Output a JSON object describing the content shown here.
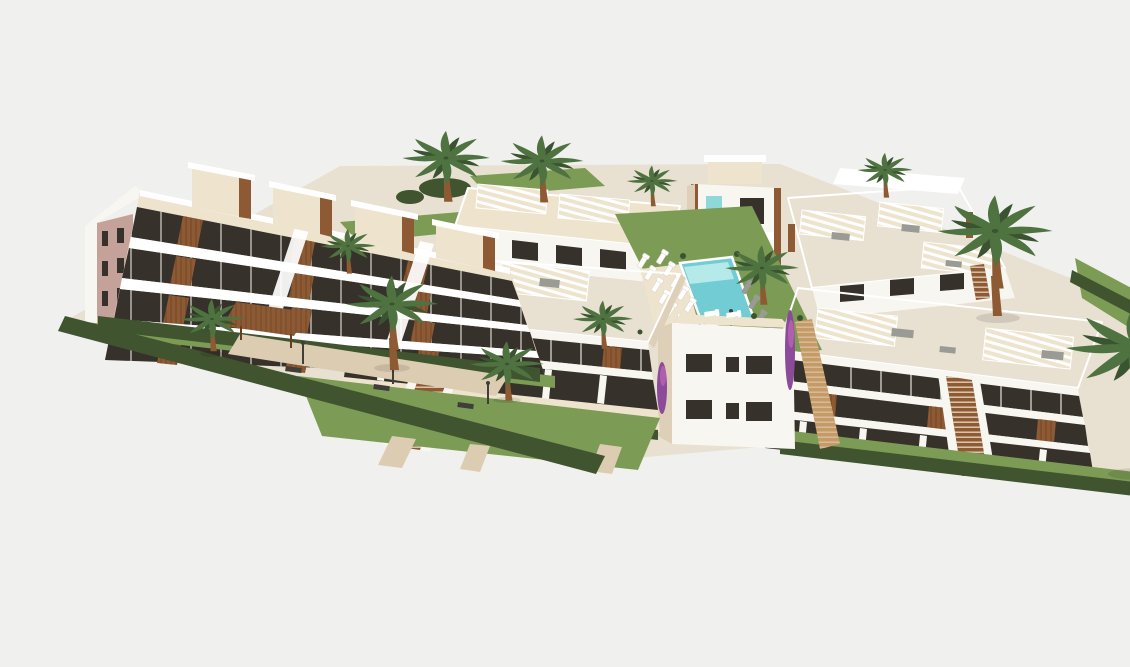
{
  "scene": {
    "type": "3d-architectural-rendering",
    "description": "Aerial 3D rendering of a modern white Mediterranean residential complex: a four-storey apartment building with stepped terraces and wooden slat panels on the left, two-storey townhouse blocks with roof terraces, striped pergolas and wooden exterior staircases in the middle and right, a communal turquoise swimming pool surrounded by lawn and sun loungers in the centre, paved walkways with benches and lamp posts, clipped hedges along the plot edges and many palm trees, all on a pale grey background.",
    "time_of_day": "day",
    "background_is_blank": true
  },
  "colors": {
    "background": "#f0f0ee",
    "ground": "#e8e0d0",
    "path": "#dccdb2",
    "path-wood": "#c49a67",
    "facade-white": "#f8f6f0",
    "facade-cream": "#eee3cc",
    "facade-tan": "#ded0b8",
    "facade-pink": "#c4a29a",
    "wood": "#8e5a33",
    "wood-dark": "#64401f",
    "glass": "#36322b",
    "glass-blue": "#8fd8da",
    "pool": "#72ccd3",
    "pool-light": "#b5e9ea",
    "lawn": "#7c9b55",
    "lawn-dark": "#63813f",
    "hedge": "#40542f",
    "palm": "#4f7340",
    "palm-dark": "#3a5330",
    "furniture-gray": "#999b94",
    "white": "#ffffff",
    "purple": "#8b4a9a",
    "magenta": "#b05fae",
    "bench": "#3f3e39"
  },
  "objects": {
    "buildings": [
      {
        "name": "left-apartment-building",
        "storeys": 4,
        "features": [
          "stepped penthouses",
          "wood slat panels",
          "pink gable end wall with six small windows",
          "balcony bands"
        ]
      },
      {
        "name": "townhouse-block-back-left",
        "storeys": 2,
        "features": [
          "roof terrace",
          "striped pergolas"
        ]
      },
      {
        "name": "central-building",
        "storeys": 3,
        "features": [
          "turquoise glass panel",
          "wood corner pillars",
          "roof box"
        ]
      },
      {
        "name": "townhouse-block-front-left",
        "storeys": 2,
        "features": [
          "large roof terrace",
          "two striped pergolas",
          "central wooden staircase"
        ]
      },
      {
        "name": "townhouse-block-back-right",
        "storeys": 2,
        "features": [
          "terraces",
          "three striped pergolas"
        ]
      },
      {
        "name": "townhouse-block-front-right",
        "storeys": 2,
        "features": [
          "roof terrace",
          "striped pergolas",
          "wooden staircase"
        ]
      },
      {
        "name": "white-corner-building",
        "storeys": 2,
        "features": [
          "six dark windows",
          "roof terrace with loungers",
          "bougainvillea"
        ]
      }
    ],
    "amenities": [
      {
        "name": "swimming-pool",
        "color": "turquoise"
      },
      {
        "name": "sun-loungers-white",
        "count": 11
      },
      {
        "name": "sun-loungers-gray",
        "count": 4
      },
      {
        "name": "benches",
        "count": 3
      },
      {
        "name": "lamp-posts",
        "count": 4
      },
      {
        "name": "pergola-carport",
        "count": 1
      }
    ],
    "landscape": [
      {
        "name": "palm-trees",
        "count": 12
      },
      {
        "name": "lawns"
      },
      {
        "name": "hedges"
      },
      {
        "name": "paved-walkways"
      }
    ]
  }
}
